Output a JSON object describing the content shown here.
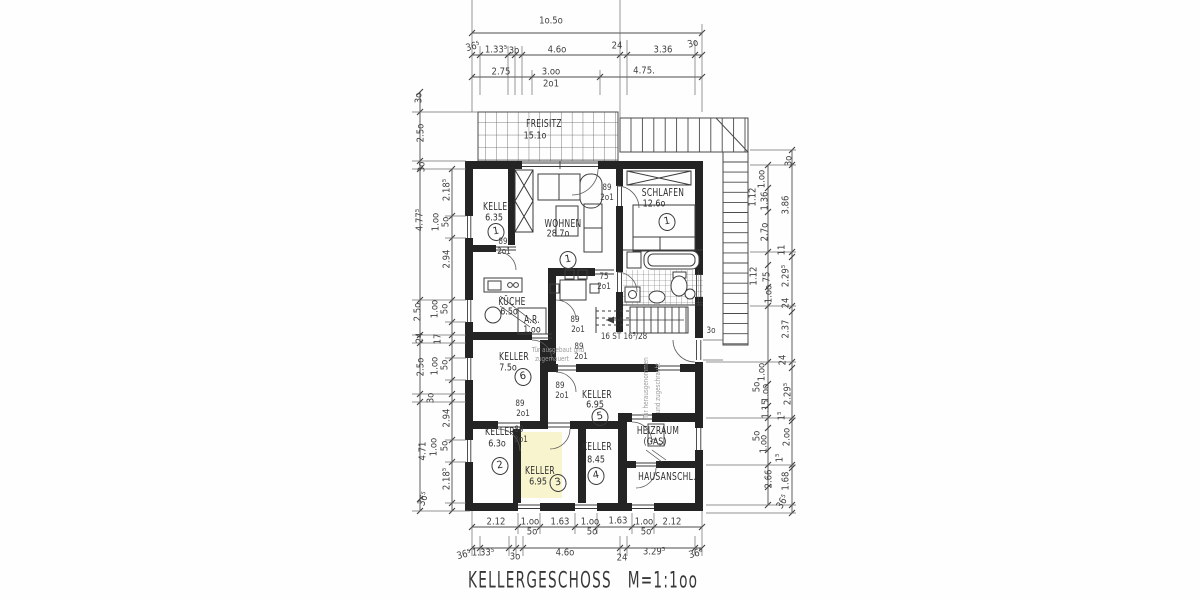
{
  "drawing_title": {
    "name": "KELLERGESCHOSS",
    "scale": "M=1:1oo"
  },
  "rooms": [
    {
      "id": "freisitz",
      "label": "FREISITZ",
      "area": "15.1o",
      "number": null,
      "lx": 544,
      "ly": 124,
      "ax": 535,
      "ay": 136
    },
    {
      "id": "keller-1",
      "label": "KELLER",
      "area": "6.35",
      "number": "1",
      "lx": 498,
      "ly": 207,
      "ax": 494,
      "ay": 218,
      "nx": 496,
      "ny": 232
    },
    {
      "id": "wohnen",
      "label": "WOHNEN",
      "area": "28.7o",
      "number": "1",
      "lx": 563,
      "ly": 224,
      "ax": 558,
      "ay": 234,
      "nx": 568,
      "ny": 260
    },
    {
      "id": "schlafen",
      "label": "SCHLAFEN",
      "area": "12.6o",
      "number": "1",
      "lx": 663,
      "ly": 193,
      "ax": 654,
      "ay": 204,
      "nx": 667,
      "ny": 222
    },
    {
      "id": "kueche",
      "label": "KÜCHE",
      "area": "6.5o",
      "number": null,
      "lx": 512,
      "ly": 302,
      "ax": 509,
      "ay": 312
    },
    {
      "id": "abstellraum",
      "label": "A.R.",
      "area": "1.oo",
      "number": null,
      "lx": 532,
      "ly": 320,
      "ax": 532,
      "ay": 330
    },
    {
      "id": "keller-6",
      "label": "KELLER",
      "area": "7.5o",
      "number": "6",
      "lx": 514,
      "ly": 357,
      "ax": 508,
      "ay": 368,
      "nx": 523,
      "ny": 377
    },
    {
      "id": "keller-2",
      "label": "KELLER",
      "area": "6.3o",
      "number": "2",
      "lx": 500,
      "ly": 432,
      "ax": 497,
      "ay": 444,
      "nx": 500,
      "ny": 466
    },
    {
      "id": "keller-3",
      "label": "KELLER",
      "area": "6.95",
      "number": "3",
      "highlight": true,
      "lx": 540,
      "ly": 471,
      "ax": 538,
      "ay": 482,
      "nx": 558,
      "ny": 483
    },
    {
      "id": "keller-4",
      "label": "KELLER",
      "area": "8.45",
      "number": "4",
      "lx": 597,
      "ly": 447,
      "ax": 596,
      "ay": 460,
      "nx": 596,
      "ny": 476
    },
    {
      "id": "keller-5",
      "label": "KELLER",
      "area": "6.95",
      "number": "5",
      "lx": 597,
      "ly": 395,
      "ax": 595,
      "ay": 405,
      "nx": 600,
      "ny": 417
    },
    {
      "id": "heizraum",
      "label": "HEIZRAUM",
      "area": "(GAS)",
      "number": null,
      "lx": 658,
      "ly": 431,
      "ax": 655,
      "ay": 442
    },
    {
      "id": "hausanschluss",
      "label": "HAUSANSCHL.",
      "area": "",
      "number": null,
      "lx": 667,
      "ly": 477
    }
  ],
  "texts": [
    {
      "t": "1o.5o",
      "x": 551,
      "y": 21,
      "k": "dim"
    },
    {
      "t": "36⁵",
      "x": 473,
      "y": 47,
      "k": "dim",
      "r": -15
    },
    {
      "t": "1.33⁵",
      "x": 496,
      "y": 50,
      "k": "dim"
    },
    {
      "t": "3o",
      "x": 514,
      "y": 51,
      "k": "dim"
    },
    {
      "t": "4.6o",
      "x": 557,
      "y": 50,
      "k": "dim"
    },
    {
      "t": "24",
      "x": 617,
      "y": 46,
      "k": "dim"
    },
    {
      "t": "3.36",
      "x": 663,
      "y": 50,
      "k": "dim"
    },
    {
      "t": "3o",
      "x": 693,
      "y": 44,
      "k": "dim",
      "r": -15
    },
    {
      "t": "2.75",
      "x": 501,
      "y": 72,
      "k": "dim"
    },
    {
      "t": "3.oo",
      "x": 551,
      "y": 72,
      "k": "dim"
    },
    {
      "t": "2o1",
      "x": 551,
      "y": 84,
      "k": "dim"
    },
    {
      "t": "4.75.",
      "x": 644,
      "y": 71,
      "k": "dim"
    },
    {
      "t": "2.12",
      "x": 496,
      "y": 522,
      "k": "dim"
    },
    {
      "t": "1.oo",
      "x": 530,
      "y": 522,
      "k": "dim"
    },
    {
      "t": "5o",
      "x": 532,
      "y": 532,
      "k": "dim"
    },
    {
      "t": "1.63",
      "x": 560,
      "y": 522,
      "k": "dim"
    },
    {
      "t": "1.oo",
      "x": 590,
      "y": 522,
      "k": "dim"
    },
    {
      "t": "5o",
      "x": 592,
      "y": 532,
      "k": "dim"
    },
    {
      "t": "1.63",
      "x": 618,
      "y": 521,
      "k": "dim"
    },
    {
      "t": "1.oo",
      "x": 644,
      "y": 522,
      "k": "dim"
    },
    {
      "t": "5o",
      "x": 646,
      "y": 532,
      "k": "dim"
    },
    {
      "t": "2.12",
      "x": 672,
      "y": 522,
      "k": "dim"
    },
    {
      "t": "36⁵",
      "x": 464,
      "y": 555,
      "k": "dim",
      "r": -15
    },
    {
      "t": "1.33⁵",
      "x": 483,
      "y": 553,
      "k": "dim"
    },
    {
      "t": "3o",
      "x": 515,
      "y": 557,
      "k": "dim"
    },
    {
      "t": "4.6o",
      "x": 565,
      "y": 553,
      "k": "dim"
    },
    {
      "t": "24",
      "x": 622,
      "y": 558,
      "k": "dim"
    },
    {
      "t": "3.29⁵",
      "x": 654,
      "y": 552,
      "k": "dim"
    },
    {
      "t": "36⁵",
      "x": 696,
      "y": 554,
      "k": "dim",
      "r": -15
    },
    {
      "t": "3o",
      "x": 419,
      "y": 98,
      "k": "dim",
      "r": -90
    },
    {
      "t": "2.5o",
      "x": 421,
      "y": 133,
      "k": "dim",
      "r": -90
    },
    {
      "t": "3o",
      "x": 422,
      "y": 167,
      "k": "dim",
      "r": -90
    },
    {
      "t": "4.77⁵",
      "x": 420,
      "y": 220,
      "k": "dim",
      "r": -90
    },
    {
      "t": "2.18⁵",
      "x": 447,
      "y": 190,
      "k": "dim",
      "r": -90
    },
    {
      "t": "1.oo",
      "x": 436,
      "y": 222,
      "k": "dim",
      "r": -90
    },
    {
      "t": "5o",
      "x": 446,
      "y": 222,
      "k": "dim",
      "r": -90
    },
    {
      "t": "2.94",
      "x": 447,
      "y": 259,
      "k": "dim",
      "r": -90
    },
    {
      "t": "2.5o",
      "x": 418,
      "y": 312,
      "k": "dim",
      "r": -90
    },
    {
      "t": "1.oo",
      "x": 435,
      "y": 309,
      "k": "dim",
      "r": -90
    },
    {
      "t": "5o",
      "x": 445,
      "y": 309,
      "k": "dim",
      "r": -90
    },
    {
      "t": "24",
      "x": 420,
      "y": 338,
      "k": "dim",
      "r": -90
    },
    {
      "t": "17",
      "x": 438,
      "y": 339,
      "k": "dim",
      "r": -90
    },
    {
      "t": "2.5o",
      "x": 421,
      "y": 367,
      "k": "dim",
      "r": -90
    },
    {
      "t": "1.oo",
      "x": 435,
      "y": 366,
      "k": "dim",
      "r": -90
    },
    {
      "t": "5o",
      "x": 445,
      "y": 365,
      "k": "dim",
      "r": -90
    },
    {
      "t": "3o",
      "x": 431,
      "y": 398,
      "k": "dim",
      "r": -90
    },
    {
      "t": "2.94",
      "x": 447,
      "y": 418,
      "k": "dim",
      "r": -90
    },
    {
      "t": "4.71",
      "x": 423,
      "y": 451,
      "k": "dim",
      "r": -90
    },
    {
      "t": "1.oo",
      "x": 434,
      "y": 447,
      "k": "dim",
      "r": -90
    },
    {
      "t": "5o",
      "x": 445,
      "y": 446,
      "k": "dim",
      "r": -90
    },
    {
      "t": "2.18⁵",
      "x": 447,
      "y": 479,
      "k": "dim",
      "r": -90
    },
    {
      "t": "36⁵",
      "x": 424,
      "y": 499,
      "k": "dim",
      "r": -70
    },
    {
      "t": "3o",
      "x": 789,
      "y": 161,
      "k": "dim",
      "r": -90
    },
    {
      "t": "1.oo",
      "x": 762,
      "y": 179,
      "k": "dim",
      "r": -90
    },
    {
      "t": "1.12",
      "x": 753,
      "y": 197,
      "k": "dim",
      "r": -90
    },
    {
      "t": "1.36",
      "x": 765,
      "y": 201,
      "k": "dim",
      "r": -90
    },
    {
      "t": "3.86",
      "x": 786,
      "y": 205,
      "k": "dim",
      "r": -90
    },
    {
      "t": "2.7o",
      "x": 765,
      "y": 232,
      "k": "dim",
      "r": -90
    },
    {
      "t": "11",
      "x": 782,
      "y": 250,
      "k": "dim",
      "r": -90
    },
    {
      "t": "2.29⁵",
      "x": 786,
      "y": 276,
      "k": "dim",
      "r": -90
    },
    {
      "t": "1.12",
      "x": 754,
      "y": 276,
      "k": "dim",
      "r": -90
    },
    {
      "t": "75",
      "x": 767,
      "y": 277,
      "k": "dim",
      "r": -90
    },
    {
      "t": "1.oo",
      "x": 769,
      "y": 294,
      "k": "dim",
      "r": -90
    },
    {
      "t": "24",
      "x": 786,
      "y": 303,
      "k": "dim",
      "r": -90
    },
    {
      "t": "2.37",
      "x": 786,
      "y": 329,
      "k": "dim",
      "r": -90
    },
    {
      "t": "24",
      "x": 783,
      "y": 360,
      "k": "dim",
      "r": -90
    },
    {
      "t": "1.oo",
      "x": 762,
      "y": 372,
      "k": "dim",
      "r": -90
    },
    {
      "t": "5o",
      "x": 757,
      "y": 387,
      "k": "dim",
      "r": -90
    },
    {
      "t": "1.oo",
      "x": 766,
      "y": 393,
      "k": "dim",
      "r": -90
    },
    {
      "t": "1.15",
      "x": 766,
      "y": 409,
      "k": "dim",
      "r": -90
    },
    {
      "t": "2.29⁵",
      "x": 788,
      "y": 394,
      "k": "dim",
      "r": -90
    },
    {
      "t": "1⁵",
      "x": 782,
      "y": 416,
      "k": "dim",
      "r": -90
    },
    {
      "t": "2.oo",
      "x": 787,
      "y": 437,
      "k": "dim",
      "r": -90
    },
    {
      "t": "5o",
      "x": 757,
      "y": 436,
      "k": "dim",
      "r": -90
    },
    {
      "t": "1.oo",
      "x": 764,
      "y": 444,
      "k": "dim",
      "r": -90
    },
    {
      "t": "1⁵",
      "x": 780,
      "y": 458,
      "k": "dim",
      "r": -90
    },
    {
      "t": "2.66",
      "x": 769,
      "y": 479,
      "k": "dim",
      "r": -90
    },
    {
      "t": "1.68",
      "x": 786,
      "y": 481,
      "k": "dim",
      "r": -90
    },
    {
      "t": "36⁵",
      "x": 783,
      "y": 502,
      "k": "dim",
      "r": -60
    },
    {
      "t": "89",
      "x": 607,
      "y": 188,
      "k": "door"
    },
    {
      "t": "2o1",
      "x": 607,
      "y": 198,
      "k": "door"
    },
    {
      "t": "89",
      "x": 503,
      "y": 242,
      "k": "door"
    },
    {
      "t": "2o1",
      "x": 504,
      "y": 252,
      "k": "door"
    },
    {
      "t": "75",
      "x": 604,
      "y": 277,
      "k": "door"
    },
    {
      "t": "2o1",
      "x": 604,
      "y": 287,
      "k": "door"
    },
    {
      "t": "89",
      "x": 575,
      "y": 320,
      "k": "door"
    },
    {
      "t": "2o1",
      "x": 578,
      "y": 330,
      "k": "door"
    },
    {
      "t": "89",
      "x": 579,
      "y": 347,
      "k": "door"
    },
    {
      "t": "2o1",
      "x": 581,
      "y": 357,
      "k": "door"
    },
    {
      "t": "89",
      "x": 560,
      "y": 386,
      "k": "door"
    },
    {
      "t": "2o1",
      "x": 562,
      "y": 396,
      "k": "door"
    },
    {
      "t": "89",
      "x": 520,
      "y": 404,
      "k": "door"
    },
    {
      "t": "2o1",
      "x": 523,
      "y": 414,
      "k": "door"
    },
    {
      "t": "89",
      "x": 519,
      "y": 430,
      "k": "door"
    },
    {
      "t": "2o1",
      "x": 521,
      "y": 440,
      "k": "door"
    },
    {
      "t": "3o",
      "x": 711,
      "y": 331,
      "k": "door"
    },
    {
      "t": "16 ST 16⁵/28",
      "x": 624,
      "y": 337,
      "k": "door",
      "n": "stair-label"
    },
    {
      "t": "Tür ausgebaut und",
      "x": 558,
      "y": 350,
      "k": "note"
    },
    {
      "t": "zugemauert",
      "x": 552,
      "y": 359,
      "k": "note"
    },
    {
      "t": "Tür herausgenommen",
      "x": 646,
      "y": 388,
      "k": "note",
      "r": -90
    },
    {
      "t": "und zugeschraubt",
      "x": 658,
      "y": 388,
      "k": "note",
      "r": -90
    }
  ],
  "colors": {
    "ink": "#333333",
    "wall": "#242424",
    "highlight": "#f3eda0",
    "paper": "#fefefe"
  }
}
